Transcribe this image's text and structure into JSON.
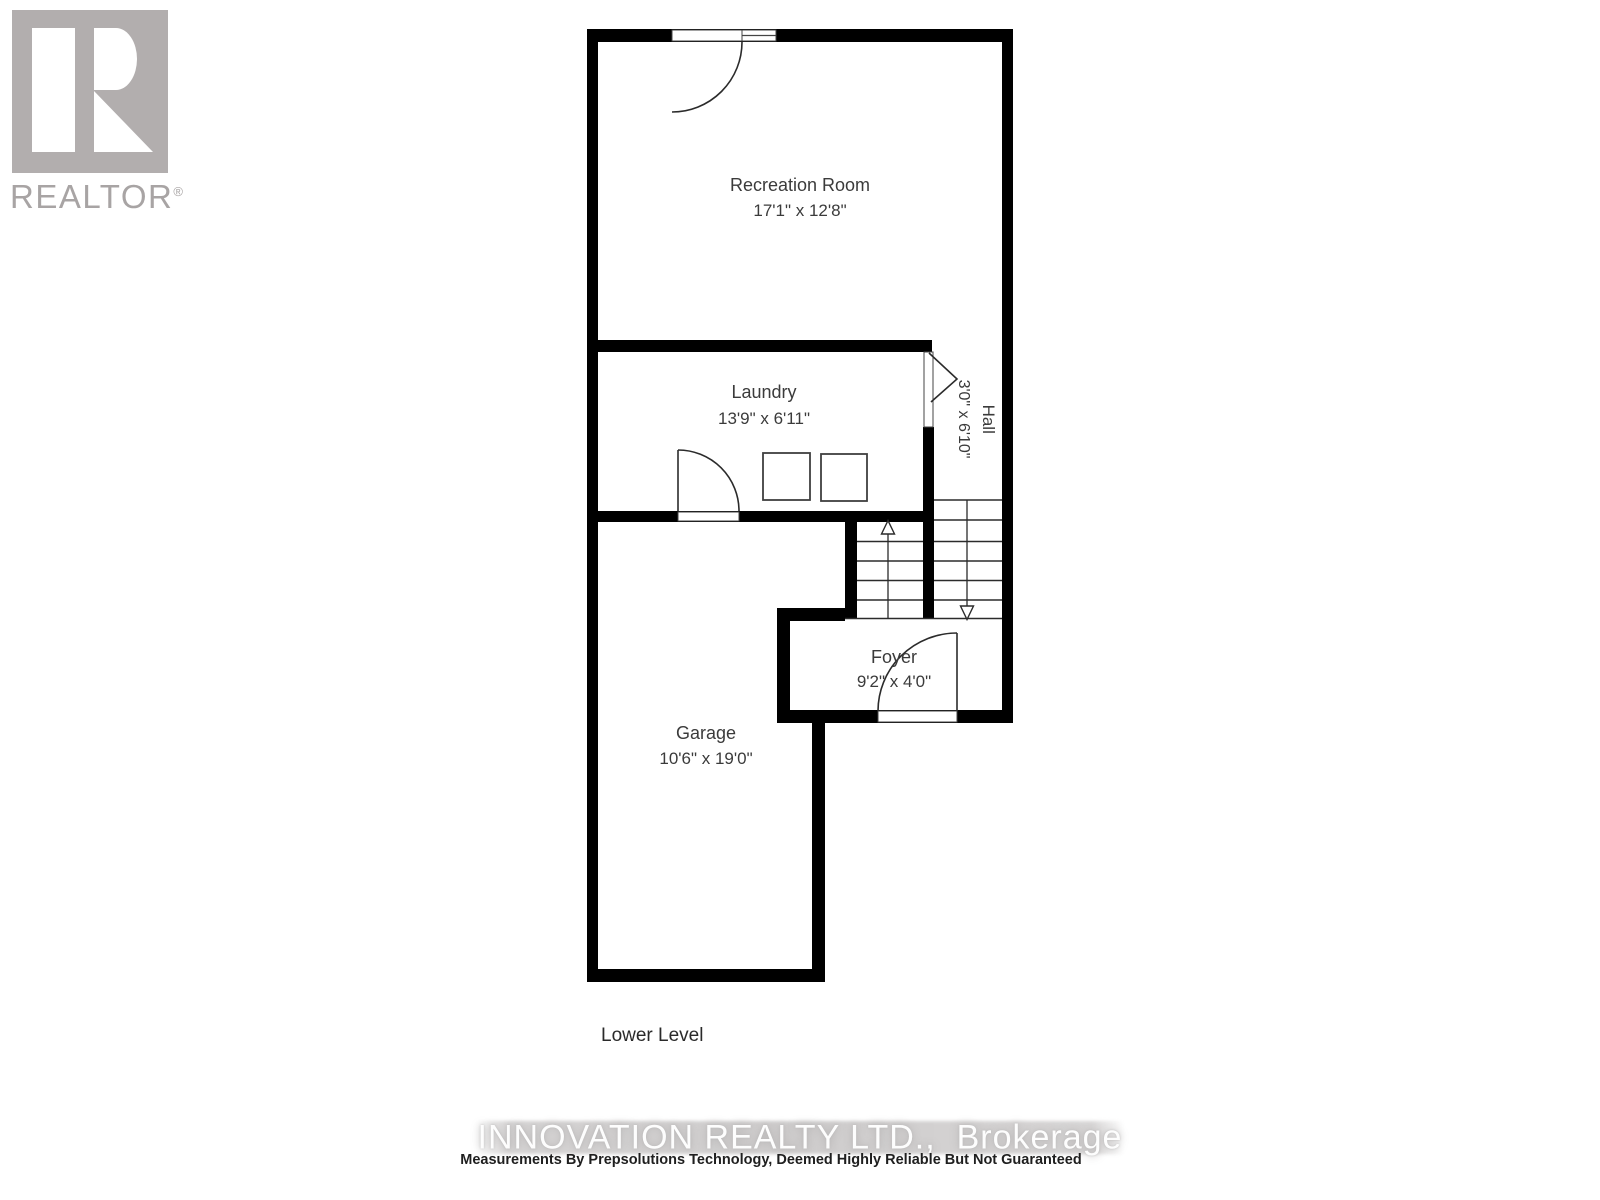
{
  "logo": {
    "brand": "REALTOR",
    "registered": "®"
  },
  "floor_plan": {
    "level_label": "Lower Level",
    "rooms": {
      "recreation": {
        "name": "Recreation Room",
        "dims": "17'1\" x 12'8\""
      },
      "laundry": {
        "name": "Laundry",
        "dims": "13'9\" x 6'11\""
      },
      "hall": {
        "name": "Hall",
        "dims": "3'0\" x 6'10\""
      },
      "foyer": {
        "name": "Foyer",
        "dims": "9'2\" x 4'0\""
      },
      "garage": {
        "name": "Garage",
        "dims": "10'6\" x 19'0\""
      }
    }
  },
  "footer": {
    "watermark": "INNOVATION REALTY LTD.,  Brokerage",
    "disclaimer": "Measurements By Prepsolutions Technology, Deemed Highly Reliable But Not Guaranteed"
  },
  "colors": {
    "wall": "#000000",
    "thin_line": "#2b2b2b",
    "label_text": "#3b3b3b",
    "logo_gray": "#b2aeae",
    "watermark_band": "#cccaca"
  }
}
